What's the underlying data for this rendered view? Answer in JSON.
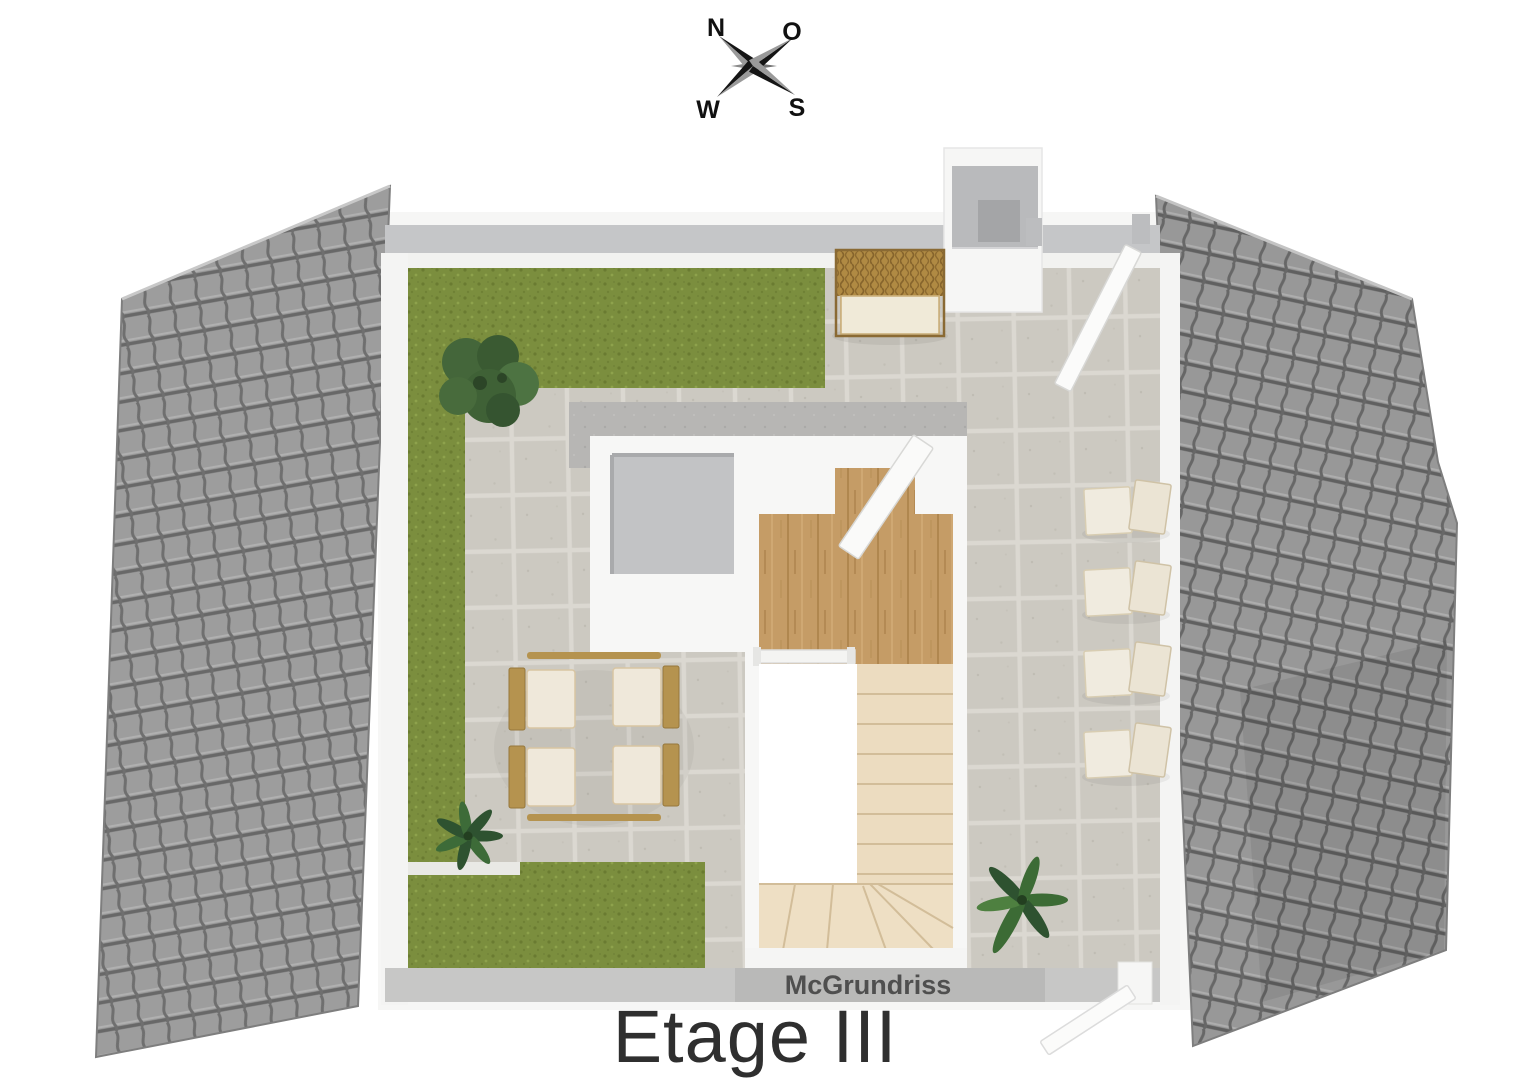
{
  "compass": {
    "north_label": "N",
    "east_label": "O",
    "west_label": "W",
    "south_label": "S"
  },
  "watermark": "McGrundriss",
  "title": "Etage III",
  "colors": {
    "background": "#ffffff",
    "roof_tile": "#9d9d9d",
    "roof_joint": "#686868",
    "grass_green": "#7b8e3e",
    "paving_gray": "#ccc9c1",
    "concrete_gray": "#b7b6b4",
    "wall_white": "#f6f6f5",
    "wall_top_gray": "#c5c6c8",
    "wood_floor": "#c59c66",
    "stair_tread": "#ecdcc0",
    "rattan_brown": "#b08a43",
    "cushion_cream": "#efe8da",
    "plant_green": "#3d6b38",
    "title_text": "#2f2f2f",
    "watermark_text": "#4f4f4f",
    "compass_dark": "#151515"
  }
}
